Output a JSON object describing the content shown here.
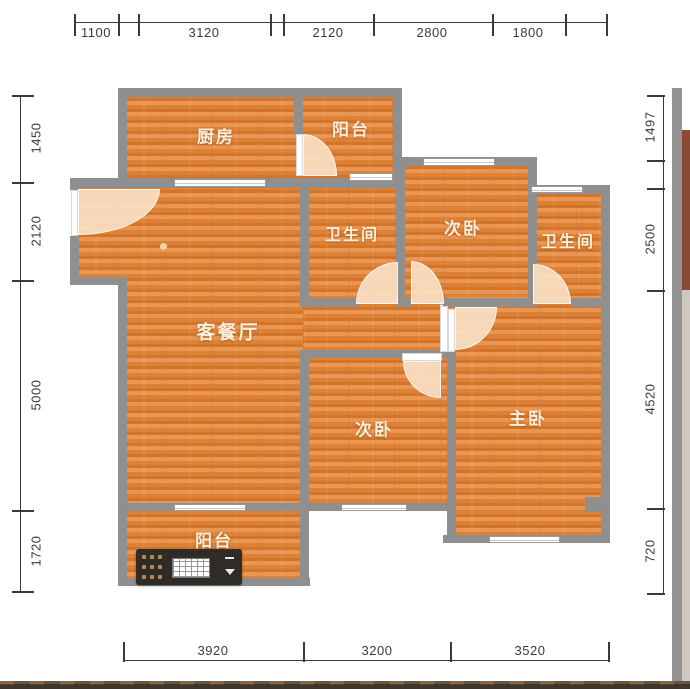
{
  "floorplan": {
    "rooms": [
      {
        "name": "kitchen",
        "label": "厨房"
      },
      {
        "name": "balcony-top",
        "label": "阳台"
      },
      {
        "name": "bathroom-1",
        "label": "卫生间"
      },
      {
        "name": "bedroom-second-upper",
        "label": "次卧"
      },
      {
        "name": "bathroom-2",
        "label": "卫生间"
      },
      {
        "name": "living-dining-room",
        "label": "客餐厅"
      },
      {
        "name": "bedroom-second-lower",
        "label": "次卧"
      },
      {
        "name": "bedroom-master",
        "label": "主卧"
      },
      {
        "name": "balcony-bottom",
        "label": "阳台"
      }
    ],
    "dimensions_mm": {
      "top": [
        "1100",
        "3120",
        "2120",
        "2800",
        "1800"
      ],
      "left": [
        "1450",
        "2120",
        "5000",
        "1720"
      ],
      "right": [
        "1497",
        "2500",
        "4520",
        "720"
      ],
      "bottom": [
        "3920",
        "3200",
        "3520"
      ]
    },
    "colors": {
      "floor_base": "#e0843a",
      "floor_plank_dark": "#d2752b",
      "wall": "#8f8f8f",
      "door_swing": "#f7dfc3",
      "dimension_text": "#3a3a3a",
      "room_label_text": "#faefdc"
    }
  }
}
